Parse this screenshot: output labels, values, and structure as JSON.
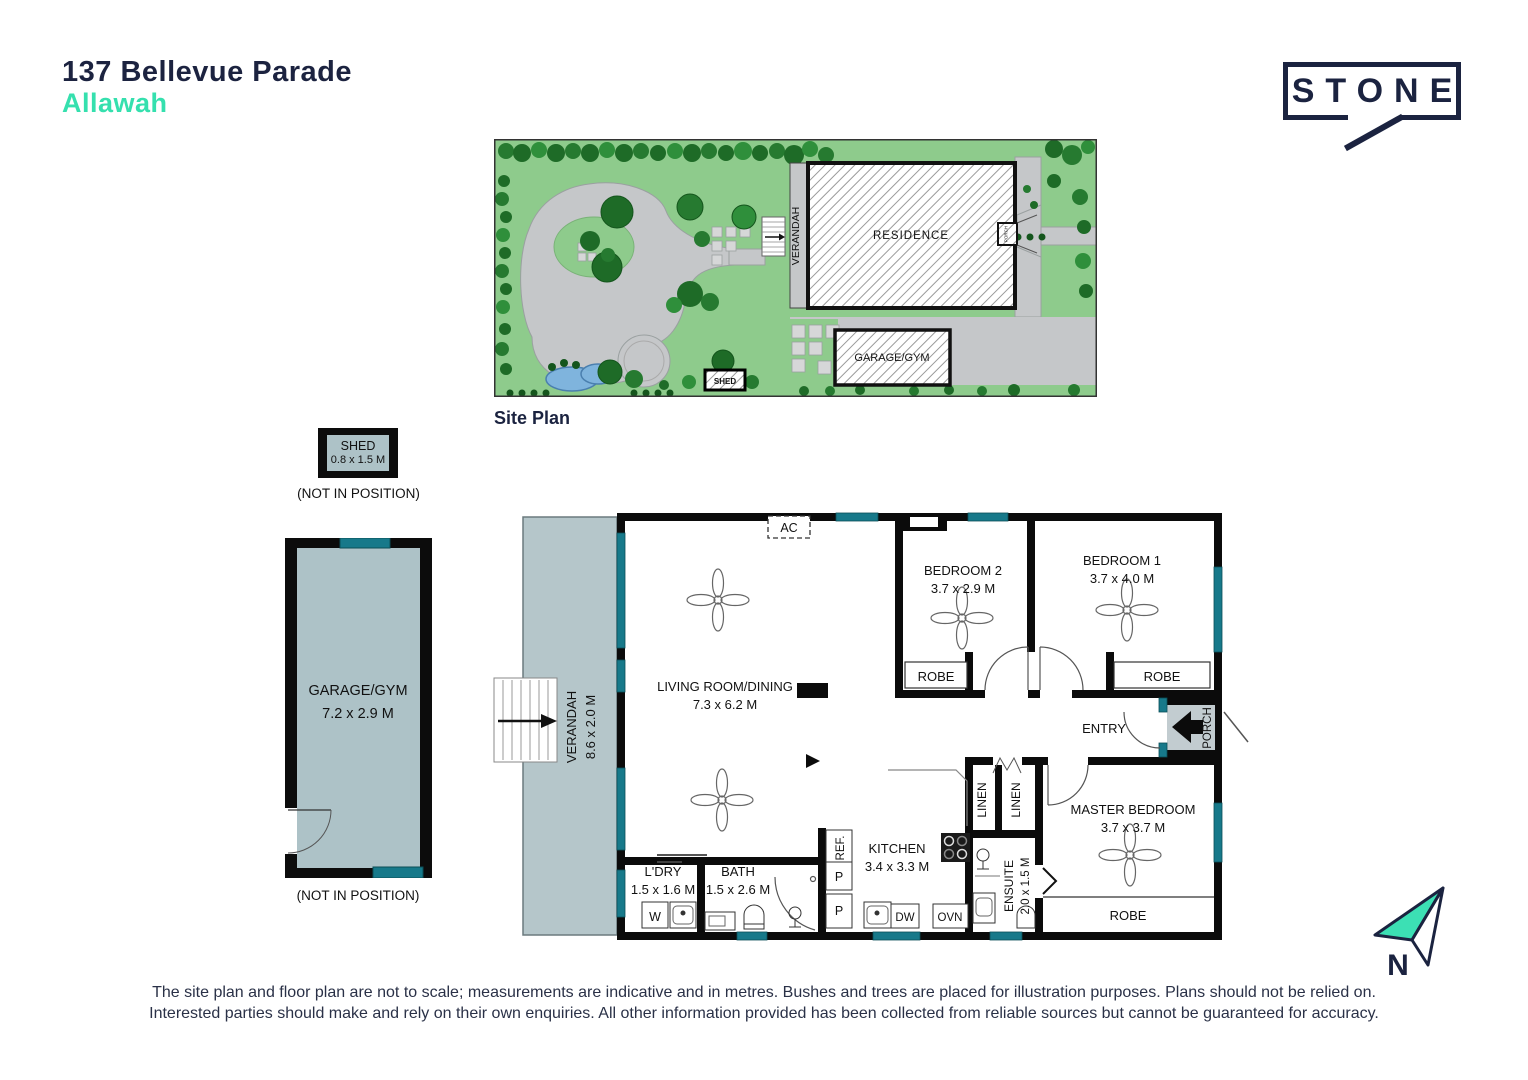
{
  "header": {
    "address": "137 Bellevue Parade",
    "suburb": "Allawah"
  },
  "logo": {
    "brand": "STONE"
  },
  "site_plan": {
    "caption": "Site Plan",
    "residence_label": "RESIDENCE",
    "verandah_label": "VERANDAH",
    "garage_label": "GARAGE/GYM",
    "porch_label": "PORCH",
    "shed_label": "SHED"
  },
  "shed_figure": {
    "name": "SHED",
    "size": "0.8 x 1.5 M",
    "note": "(NOT IN POSITION)"
  },
  "garage_figure": {
    "name": "GARAGE/GYM",
    "size": "7.2 x 2.9 M",
    "note": "(NOT IN POSITION)"
  },
  "floor_plan": {
    "verandah": {
      "name": "VERANDAH",
      "size": "8.6 x 2.0 M"
    },
    "living": {
      "name": "LIVING ROOM/DINING",
      "size": "7.3 x 6.2 M"
    },
    "bedroom2": {
      "name": "BEDROOM 2",
      "size": "3.7 x 2.9 M"
    },
    "bedroom1": {
      "name": "BEDROOM 1",
      "size": "3.7 x 4.0 M"
    },
    "master_bedroom": {
      "name": "MASTER BEDROOM",
      "size": "3.7 x 3.7 M"
    },
    "kitchen": {
      "name": "KITCHEN",
      "size": "3.4 x 3.3 M"
    },
    "bath": {
      "name": "BATH",
      "size": "1.5 x 2.6 M"
    },
    "laundry": {
      "name": "L'DRY",
      "size": "1.5 x 1.6 M"
    },
    "ensuite": {
      "name": "ENSUITE",
      "size": "2.0 x 1.5 M"
    },
    "entry_label": "ENTRY",
    "porch_label": "PORCH",
    "robe_label": "ROBE",
    "linen_label": "LINEN",
    "ac_label": "AC",
    "ref_label": "REF.",
    "pantry_label": "P",
    "dishwasher_label": "DW",
    "oven_label": "OVN",
    "washer_label": "W"
  },
  "compass": {
    "north_label": "N"
  },
  "disclaimer": {
    "line1": "The site plan and floor plan are not to scale; measurements are indicative and in metres. Bushes and trees are placed for illustration purposes. Plans should not be relied on.",
    "line2": "Interested parties should make and rely on their own enquiries. All other information provided has been collected from reliable sources but cannot be guaranteed for accuracy."
  },
  "colors": {
    "navy": "#1b2340",
    "mint": "#35e0ae",
    "window_teal": "#17798a",
    "plan_fill": "#adc2c7",
    "verandah_fill": "#b5c6ca",
    "porch_fill": "#c2ccd0",
    "garden_green": "#8ecb8c",
    "tree_dark": "#1e6b27",
    "path_gray": "#c5c7c9",
    "pond_blue": "#7fb4dd",
    "wall_black": "#0b0b0b"
  }
}
